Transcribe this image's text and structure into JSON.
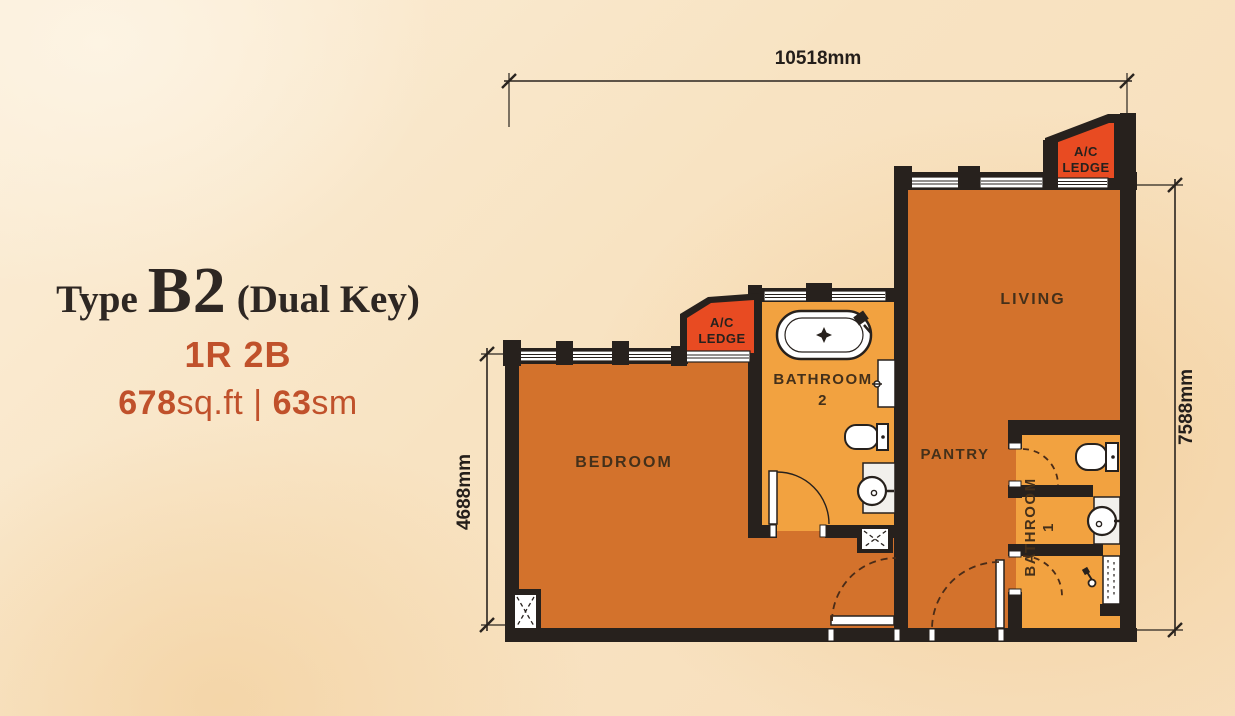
{
  "title": {
    "prefix": "Type",
    "code": "B2",
    "suffix": "(Dual Key)",
    "layout": "1R 2B",
    "area_sqft_value": "678",
    "area_sqft_unit": "sq.ft",
    "divider": "|",
    "area_sm_value": "63",
    "area_sm_unit": "sm"
  },
  "dimensions": {
    "top_width": "10518mm",
    "right_height": "7588mm",
    "left_height": "4688mm"
  },
  "rooms": {
    "bedroom": "BEDROOM",
    "living": "LIVING",
    "pantry": "PANTRY",
    "bathroom2_line1": "BATHROOM",
    "bathroom2_line2": "2",
    "bathroom1_line1": "BATHROOM",
    "bathroom1_line2": "1",
    "ac_ledge_line1": "A/C",
    "ac_ledge_line2": "LEDGE"
  },
  "colors": {
    "background": "#f8e3c2",
    "room_main": "#d3722c",
    "room_bathroom": "#f2a240",
    "ac_ledge_red": "#e84b22",
    "wall": "#27211d",
    "accent_text": "#c0512b",
    "title_text": "#2e2723",
    "door_swing_dashed": "#4a2c18"
  }
}
